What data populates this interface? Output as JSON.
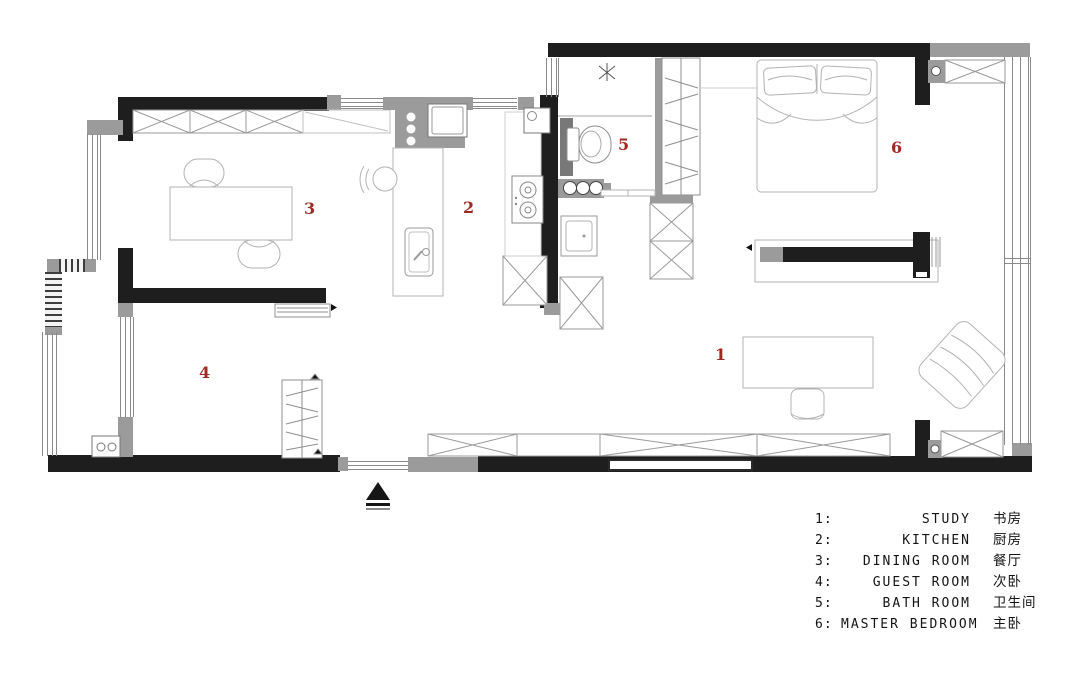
{
  "title": "apartment-floor-plan",
  "colors": {
    "wall": "#1e1e1e",
    "gray_wall": "#9b9b9b",
    "furniture_line": "#b3b3b3",
    "room_number": "#9e2a22",
    "background": "#ffffff"
  },
  "rooms": [
    {
      "marker": "1",
      "legend_num": "1:",
      "en": "STUDY",
      "zh": "书房"
    },
    {
      "marker": "2",
      "legend_num": "2:",
      "en": "KITCHEN",
      "zh": "厨房"
    },
    {
      "marker": "3",
      "legend_num": "3:",
      "en": "DINING ROOM",
      "zh": "餐厅"
    },
    {
      "marker": "4",
      "legend_num": "4:",
      "en": "GUEST ROOM",
      "zh": "次卧"
    },
    {
      "marker": "5",
      "legend_num": "5:",
      "en": "BATH ROOM",
      "zh": "卫生间"
    },
    {
      "marker": "6",
      "legend_num": "6:",
      "en": "MASTER BEDROOM",
      "zh": "主卧"
    }
  ]
}
